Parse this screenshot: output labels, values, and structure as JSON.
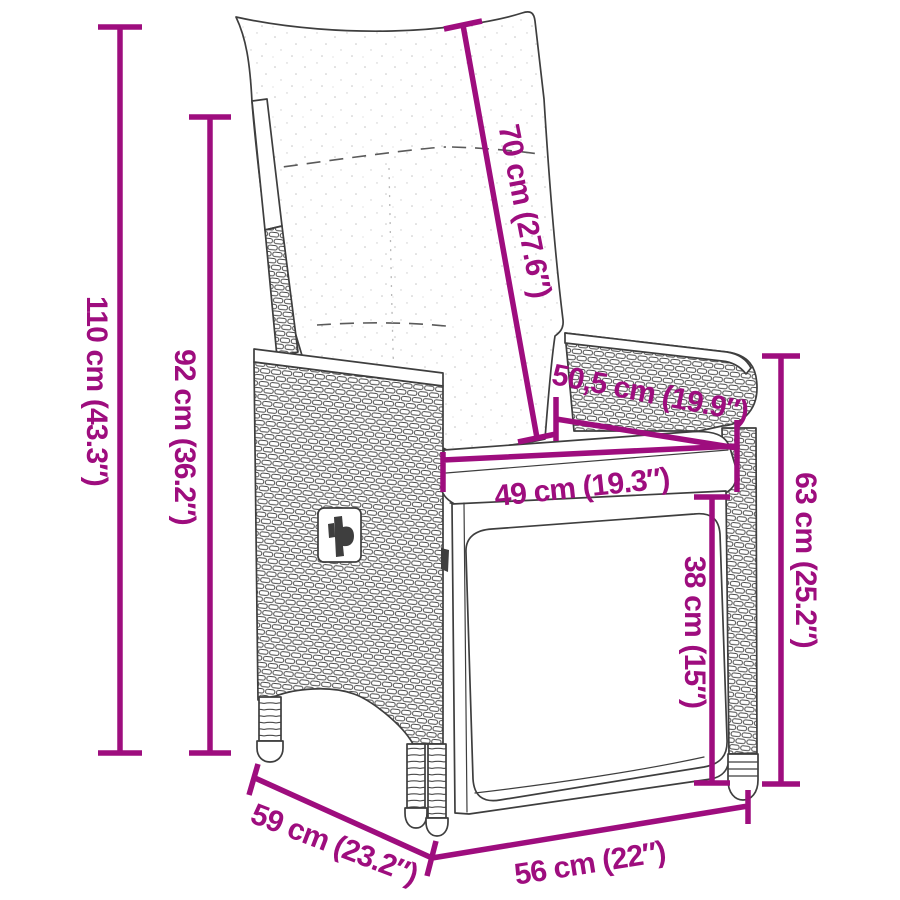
{
  "diagram": {
    "subject": "Reclining rattan garden chair with cushions — dimension drawing",
    "accent_color": "#9E0D7E",
    "outline_color": "#3E3E3E",
    "background_color": "#FFFFFF",
    "units": [
      "cm",
      "in"
    ],
    "dimensions": {
      "height_total": {
        "label": "110 cm (43.3″)"
      },
      "height_backrest": {
        "label": "92 cm (36.2″)"
      },
      "length_backrest": {
        "label": "70 cm (27.6″)"
      },
      "depth_armrest": {
        "label": "50,5 cm (19.9″)"
      },
      "width_seat": {
        "label": "49 cm (19.3″)"
      },
      "height_side": {
        "label": "63 cm (25.2″)"
      },
      "height_footrest": {
        "label": "38 cm (15″)"
      },
      "depth_total": {
        "label": "59 cm (23.2″)"
      },
      "width_total": {
        "label": "56 cm (22″)"
      }
    }
  }
}
